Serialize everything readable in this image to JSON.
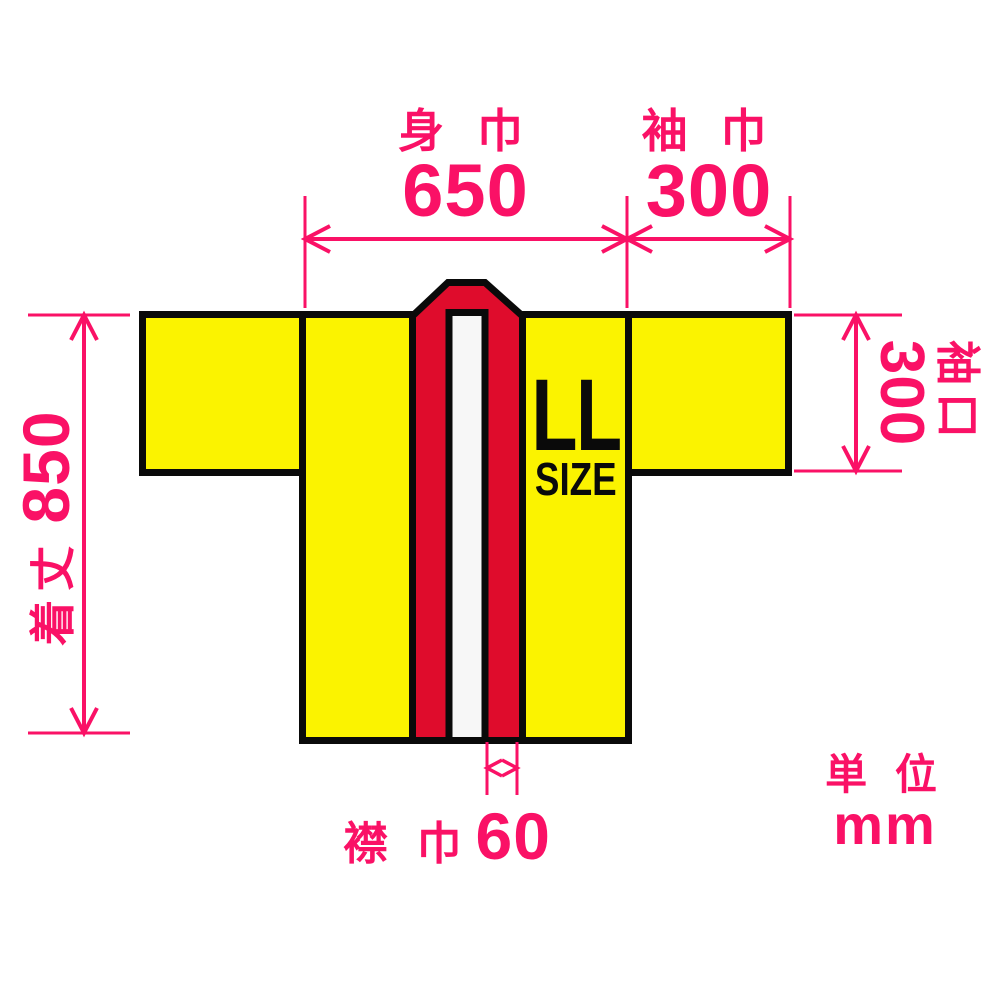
{
  "garment": {
    "size_badge": {
      "size": "LL",
      "suffix": "SIZE"
    },
    "colors": {
      "fabric": "#FBF300",
      "collar": "#DF0C2C",
      "collar_stripe": "#F7F7F7",
      "outline": "#0A0A0A",
      "dimension_pink": "#FA1166",
      "background": "#FFFFFF"
    }
  },
  "dimensions": {
    "body_width": {
      "label": "身 巾",
      "value": "650"
    },
    "sleeve_width": {
      "label": "袖 巾",
      "value": "300"
    },
    "garment_length": {
      "label": "着丈",
      "value": "850"
    },
    "sleeve_opening": {
      "label": "袖口",
      "value": "300"
    },
    "collar_width": {
      "label": "襟 巾",
      "value": "60"
    }
  },
  "unit": {
    "label": "単 位",
    "value": "mm"
  }
}
